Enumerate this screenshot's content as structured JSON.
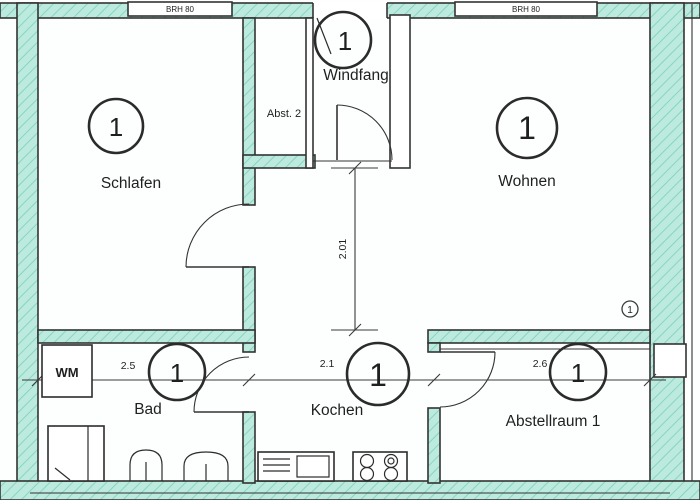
{
  "floorplan": {
    "rooms": {
      "schlafen": {
        "label": "Schlafen",
        "number": "1"
      },
      "windfang": {
        "label": "Windfang",
        "number": "1"
      },
      "wohnen": {
        "label": "Wohnen",
        "number": "1"
      },
      "bad": {
        "label": "Bad",
        "number": "1"
      },
      "kochen": {
        "label": "Kochen",
        "number": "1"
      },
      "abstellraum": {
        "label": "Abstellraum 1",
        "number": "1"
      },
      "abst2": {
        "label": "Abst. 2"
      }
    },
    "appliances": {
      "washing_machine": "WM"
    },
    "windows": {
      "top_left": "BRH 80",
      "top_right": "BRH 80"
    },
    "dimensions": {
      "bad_width": "2.5",
      "kochen_width": "2.1",
      "abstellraum_width": "2.6",
      "flur_depth": "2.01"
    },
    "wall_marker": "1",
    "colors": {
      "wall_fill": "#bceade",
      "wall_hatch": "#7fd2b8",
      "line": "#333333"
    }
  }
}
